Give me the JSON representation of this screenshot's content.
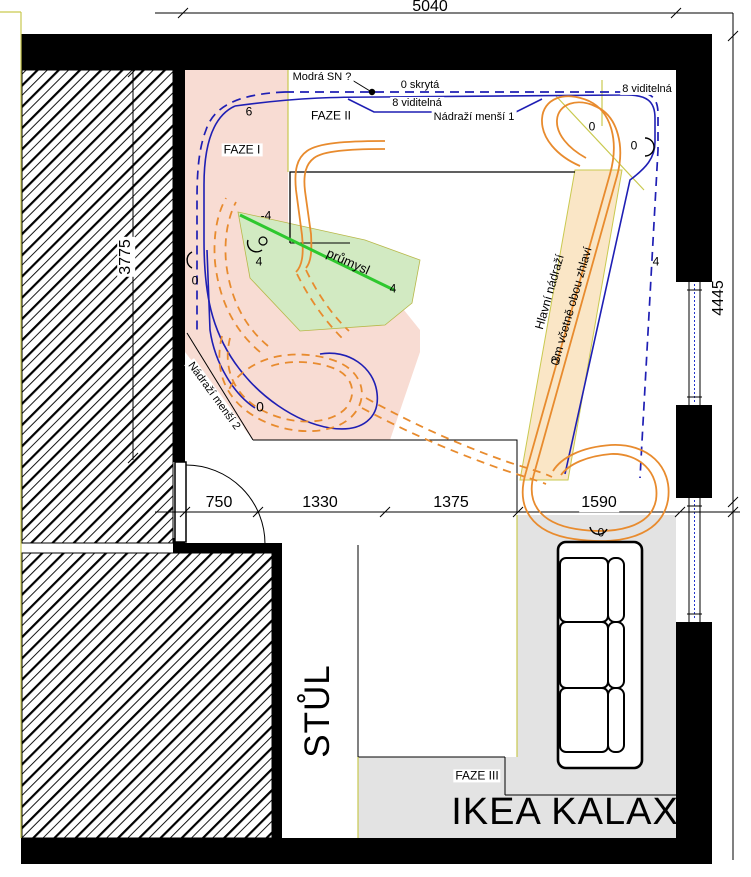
{
  "drawing": {
    "type": "floor-plan-track-layout",
    "dimensions": {
      "top": "5040",
      "left": "3775",
      "right": "4445",
      "bottom": [
        "750",
        "1330",
        "1375",
        "1590"
      ]
    },
    "labels": {
      "modra_sn": "Modrá SN ?",
      "skryta": "0 skrytá",
      "viditelna_mid": "8 viditelná",
      "viditelna_right": "8 viditelná",
      "faze1": "FAZE I",
      "faze2": "FAZE II",
      "faze3": "FAZE III",
      "nadrazi1": "Nádraží menší 1",
      "nadrazi2": "Nádraží menší 2",
      "hlavni_nadrazi": "Hlavní nádraží",
      "hlavni_nadrazi_note": "3m včetně obou zhlaví",
      "prumysl": "průmysl",
      "stul": "STŮL",
      "ikea": "IKEA KALAX"
    },
    "track_marks": {
      "m6": "6",
      "m_minus4": "-4",
      "m4_left": "4",
      "m0_left": "0",
      "m4_green": "4",
      "m0_loop2": "0",
      "m0_tr1": "0",
      "m0_tr2": "0",
      "m4_right": "4",
      "m0_sofa": "0",
      "m0_band": "0"
    },
    "colors": {
      "zone_faze1_pink": "#f8dcd3",
      "zone_prumysl_green": "#d2eac2",
      "zone_hlavni_band_orange": "#fae6c6",
      "zone_ikea_gray": "#e3e3e3",
      "track_visible_orange": "#e88b2e",
      "track_blue": "#1f1fb4",
      "construction_yellow": "#c9c94f",
      "prumysl_line_green": "#2ec82e",
      "walls": "#000000"
    }
  }
}
